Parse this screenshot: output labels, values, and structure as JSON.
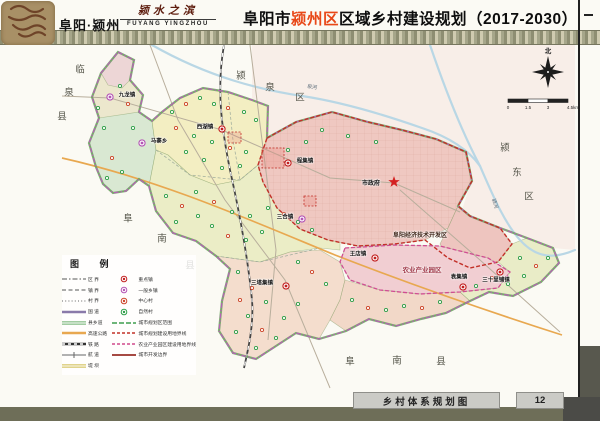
{
  "header": {
    "logo_text": "阜阳·颍州",
    "slogan": "颍水之滨",
    "slogan_en": "FUYANG YINGZHOU",
    "title_pre": "阜阳市",
    "title_highlight": "颍州区",
    "title_post": "区域乡村建设规划（2017-2030）",
    "highlight_color": "#e84818"
  },
  "footer": {
    "map_title": "乡村体系规划图",
    "page_number": "12"
  },
  "compass": {
    "north_label": "北"
  },
  "scalebar": {
    "ticks": [
      "0",
      "1.5",
      "3",
      "4.5km"
    ]
  },
  "legend": {
    "title": "图  例",
    "line_items": [
      {
        "label": "区  界",
        "sym": "dashdot"
      },
      {
        "label": "镇  界",
        "sym": "dash"
      },
      {
        "label": "村  界",
        "sym": "dot"
      },
      {
        "label": "国  道",
        "sym": "purple-solid"
      },
      {
        "label": "县乡道",
        "sym": "green-double"
      },
      {
        "label": "高速公路",
        "sym": "orange-solid"
      },
      {
        "label": "铁  路",
        "sym": "railway"
      },
      {
        "label": "航  道",
        "sym": "tick-line"
      },
      {
        "label": "堤  坝",
        "sym": "yellow-double"
      }
    ],
    "point_items": [
      {
        "label": "重点镇",
        "sym": "key"
      },
      {
        "label": "一般乡镇",
        "sym": "township"
      },
      {
        "label": "中心村",
        "sym": "center-village"
      },
      {
        "label": "自然村",
        "sym": "natural-village"
      },
      {
        "label": "城市规划区范围",
        "sym": "green-dash"
      },
      {
        "label": "城市规划建设用地界线",
        "sym": "red-dash"
      },
      {
        "label": "农业产业园区建设用地界线",
        "sym": "pink-dash"
      },
      {
        "label": "城市开发边界",
        "sym": "darkred-solid"
      }
    ]
  },
  "map": {
    "district_outline": "118,52 134,60 130,80 143,95 139,112 152,121 162,112 180,98 203,88 228,92 252,100 268,106 267,138 296,122 332,112 368,122 402,130 436,139 466,152 472,181 458,206 470,216 500,228 527,238 553,248 559,263 541,282 513,296 489,292 470,301 446,313 421,319 396,326 369,319 346,331 319,339 296,333 276,346 256,359 233,353 219,331 222,301 230,269 216,256 196,241 173,233 156,211 149,186 139,179 126,191 113,193 103,184 96,167 89,143 99,118 92,97 101,73",
    "outside_tint": {
      "points": "252,45 575,45 575,250 553,248 520,236 490,224 462,210 470,185 464,154 434,140 400,131 366,123 330,113 294,123 266,139 264,106 252,100",
      "fill": "#f6e3de",
      "opacity": 0.55
    },
    "regions": [
      {
        "name": "jiulong-area",
        "points": "118,52 134,60 130,80 143,95 139,112 152,121 156,150 149,186 139,179 126,191 113,193 103,184 96,167 89,143 99,118 92,97 101,73",
        "fill": "#ece7cd"
      },
      {
        "name": "jiulong-top",
        "points": "118,52 134,60 130,80 122,88 108,85 101,73",
        "fill": "#edd6d6"
      },
      {
        "name": "mazhai-area",
        "points": "99,118 139,112 152,121 156,150 149,186 139,179 126,191 113,193 103,184 96,167 89,143",
        "fill": "#d9e8d2"
      },
      {
        "name": "xihu-area",
        "points": "152,121 162,112 180,98 203,88 228,92 252,100 268,106 267,138 258,165 240,180 215,185 190,175 168,155 156,150",
        "fill": "#f3eec2"
      },
      {
        "name": "central-area",
        "points": "149,186 156,211 173,233 196,241 216,256 230,269 260,262 290,252 320,248 340,250 340,238 330,235 300,228 277,208 263,182 258,165 240,180 215,185 190,175 168,155 156,150",
        "fill": "#ebedc6"
      },
      {
        "name": "urban-area",
        "points": "267,138 296,122 332,112 368,122 402,130 436,139 466,152 472,181 458,206 448,228 425,240 395,244 358,246 328,240 300,229 277,208 263,182 258,165",
        "fill": "#efc8c1"
      },
      {
        "name": "kaifaqu-area",
        "points": "448,228 458,206 470,216 500,228 512,244 498,262 470,268 448,258 440,244",
        "fill": "#eec5bf"
      },
      {
        "name": "agripark-area",
        "points": "345,248 395,245 440,246 488,258 510,272 498,288 460,292 420,294 380,290 350,280 340,262",
        "fill": "#f1ced2"
      },
      {
        "name": "south-area",
        "points": "216,256 230,269 222,301 219,331 233,353 256,359 276,346 296,333 319,339 330,320 340,300 345,280 340,262 320,250 290,252 260,262",
        "fill": "#f4ddcd"
      },
      {
        "name": "southeast-strip",
        "points": "345,280 380,290 420,294 460,292 470,301 446,313 421,319 396,326 369,319 346,331 330,320 340,300",
        "fill": "#f2d8c8"
      },
      {
        "name": "east-area",
        "points": "512,244 527,238 553,248 559,263 541,282 513,296 489,292 470,301 460,292 498,288 510,272 498,262",
        "fill": "#e9ecc7"
      }
    ],
    "special_boundaries": [
      {
        "name": "urban-construction-boundary",
        "points": "267,138 296,122 332,112 368,122 402,130 436,139 466,152 472,181 458,206 470,216 500,228 512,244 498,262 470,268 448,258 425,240 395,244 358,246 328,240 300,229 277,208 263,182 258,165",
        "color": "#c23028",
        "dash": "4 2",
        "w": 1.4
      },
      {
        "name": "agripark-boundary",
        "points": "345,248 395,245 440,246 488,258 510,272 498,288 460,292 420,294 380,290 350,280 340,262",
        "color": "#cf4d92",
        "dash": "4 2",
        "w": 1.3
      }
    ],
    "internal_lines": [
      "M156,150 L190,175 L240,180 L258,165",
      "M228,92 L233,140 L240,180",
      "M216,256 L260,262 L320,248"
    ],
    "rivers": [
      "M152,45 C210,78 262,90 302,96 C342,102 385,115 422,128 C452,138 470,152 480,166",
      "M430,45 C446,92 462,132 480,166",
      "M480,166 C494,198 504,222 520,240 C538,260 556,258 575,250"
    ],
    "river_labels": [
      {
        "label": "泉河",
        "x": 312,
        "y": 88,
        "rot": 8
      },
      {
        "label": "颍河",
        "x": 494,
        "y": 204,
        "rot": 72
      }
    ],
    "roads": [
      {
        "d": "M62,96 L110,98 L222,130 L330,178 L394,183 L460,212",
        "color": "#b8ae9c",
        "w": 1
      },
      {
        "d": "M250,45 L262,140 L276,250 L268,340",
        "color": "#b8ae9c",
        "w": 1
      },
      {
        "d": "M150,45 L178,120 L225,200 L285,280 L330,388",
        "color": "#b8ae9c",
        "w": 1
      },
      {
        "d": "M400,190 L480,260 L560,332",
        "color": "#b8ae9c",
        "w": 1
      },
      {
        "d": "M62,158 C160,180 250,220 335,255 C420,288 490,312 562,335",
        "color": "#e8a850",
        "w": 1.7
      }
    ],
    "railway": "M224,45 C216,90 222,130 230,170 C240,215 248,260 252,300 C254,325 248,350 244,368",
    "construction_sites": [
      [
        262,
        148,
        22,
        20
      ],
      [
        228,
        132,
        13,
        11
      ],
      [
        304,
        196,
        12,
        10
      ]
    ],
    "towns": [
      {
        "name": "九龙镇",
        "type": "township",
        "x": 110,
        "y": 97,
        "lx": 127,
        "ly": 96
      },
      {
        "name": "马寨乡",
        "type": "township",
        "x": 142,
        "y": 143,
        "lx": 159,
        "ly": 142
      },
      {
        "name": "西湖镇",
        "type": "key",
        "x": 222,
        "y": 129,
        "lx": 205,
        "ly": 128
      },
      {
        "name": "程集镇",
        "type": "key",
        "x": 288,
        "y": 163,
        "lx": 305,
        "ly": 162
      },
      {
        "name": "三合镇",
        "type": "township",
        "x": 302,
        "y": 219,
        "lx": 285,
        "ly": 218
      },
      {
        "name": "王店镇",
        "type": "key",
        "x": 375,
        "y": 258,
        "lx": 358,
        "ly": 255
      },
      {
        "name": "袁集镇",
        "type": "key",
        "x": 463,
        "y": 287,
        "lx": 459,
        "ly": 278
      },
      {
        "name": "三十里铺镇",
        "type": "key",
        "x": 500,
        "y": 272,
        "lx": 496,
        "ly": 281
      },
      {
        "name": "三塔集镇",
        "type": "key",
        "x": 286,
        "y": 286,
        "lx": 262,
        "ly": 284
      }
    ],
    "city_gov": {
      "label": "市政府",
      "x": 394,
      "y": 182,
      "lx": 371,
      "ly": 184
    },
    "zones": [
      {
        "label": "阜阳经济技术开发区",
        "x": 420,
        "y": 236,
        "color": "#42291c",
        "size": 6
      },
      {
        "label": "农业产业园区",
        "x": 422,
        "y": 271,
        "color": "#a03848",
        "size": 6.5
      }
    ],
    "adjacent_regions": [
      {
        "label": "临泉县",
        "chars": [
          [
            80,
            70
          ],
          [
            69,
            93
          ],
          [
            62,
            117
          ]
        ]
      },
      {
        "label": "颍泉区",
        "chars": [
          [
            241,
            76
          ],
          [
            270,
            88
          ],
          [
            300,
            98
          ]
        ]
      },
      {
        "label": "颍东区",
        "chars": [
          [
            505,
            148
          ],
          [
            517,
            173
          ],
          [
            529,
            197
          ]
        ]
      },
      {
        "label": "阜南县",
        "chars": [
          [
            128,
            219
          ],
          [
            162,
            239
          ],
          [
            190,
            266
          ]
        ]
      },
      {
        "label": "阜南县",
        "chars": [
          [
            350,
            362
          ],
          [
            397,
            361
          ],
          [
            441,
            362
          ]
        ]
      }
    ],
    "villages": [
      [
        104,
        128,
        "n"
      ],
      [
        112,
        158,
        "c"
      ],
      [
        122,
        172,
        "n"
      ],
      [
        98,
        108,
        "n"
      ],
      [
        120,
        86,
        "n"
      ],
      [
        128,
        104,
        "c"
      ],
      [
        133,
        128,
        "n"
      ],
      [
        107,
        178,
        "n"
      ],
      [
        172,
        112,
        "n"
      ],
      [
        186,
        104,
        "c"
      ],
      [
        200,
        98,
        "n"
      ],
      [
        214,
        104,
        "n"
      ],
      [
        228,
        108,
        "c"
      ],
      [
        244,
        112,
        "n"
      ],
      [
        256,
        120,
        "n"
      ],
      [
        176,
        128,
        "c"
      ],
      [
        194,
        136,
        "n"
      ],
      [
        212,
        142,
        "n"
      ],
      [
        230,
        148,
        "c"
      ],
      [
        246,
        152,
        "n"
      ],
      [
        204,
        160,
        "n"
      ],
      [
        222,
        168,
        "n"
      ],
      [
        240,
        166,
        "n"
      ],
      [
        186,
        152,
        "n"
      ],
      [
        166,
        196,
        "n"
      ],
      [
        182,
        206,
        "c"
      ],
      [
        198,
        216,
        "n"
      ],
      [
        212,
        226,
        "n"
      ],
      [
        228,
        236,
        "c"
      ],
      [
        246,
        240,
        "n"
      ],
      [
        262,
        232,
        "n"
      ],
      [
        176,
        222,
        "n"
      ],
      [
        196,
        192,
        "n"
      ],
      [
        214,
        202,
        "c"
      ],
      [
        232,
        212,
        "n"
      ],
      [
        250,
        216,
        "n"
      ],
      [
        268,
        208,
        "n"
      ],
      [
        284,
        214,
        "c"
      ],
      [
        298,
        222,
        "n"
      ],
      [
        312,
        230,
        "n"
      ],
      [
        238,
        272,
        "n"
      ],
      [
        252,
        288,
        "c"
      ],
      [
        266,
        302,
        "n"
      ],
      [
        248,
        316,
        "n"
      ],
      [
        236,
        332,
        "n"
      ],
      [
        262,
        330,
        "c"
      ],
      [
        284,
        318,
        "n"
      ],
      [
        298,
        304,
        "n"
      ],
      [
        240,
        300,
        "c"
      ],
      [
        276,
        338,
        "n"
      ],
      [
        256,
        348,
        "n"
      ],
      [
        298,
        262,
        "n"
      ],
      [
        312,
        272,
        "c"
      ],
      [
        326,
        284,
        "n"
      ],
      [
        352,
        300,
        "n"
      ],
      [
        368,
        308,
        "c"
      ],
      [
        386,
        310,
        "n"
      ],
      [
        404,
        306,
        "n"
      ],
      [
        422,
        308,
        "c"
      ],
      [
        440,
        302,
        "n"
      ],
      [
        476,
        286,
        "n"
      ],
      [
        492,
        278,
        "c"
      ],
      [
        508,
        284,
        "n"
      ],
      [
        524,
        276,
        "n"
      ],
      [
        536,
        266,
        "c"
      ],
      [
        548,
        258,
        "n"
      ],
      [
        520,
        258,
        "n"
      ],
      [
        288,
        150,
        "n"
      ],
      [
        306,
        142,
        "n"
      ],
      [
        322,
        130,
        "n"
      ],
      [
        348,
        136,
        "n"
      ],
      [
        376,
        142,
        "n"
      ]
    ],
    "compass": {
      "x": 548,
      "y": 72
    },
    "scalebar_pos": {
      "x": 508,
      "y": 99
    }
  }
}
